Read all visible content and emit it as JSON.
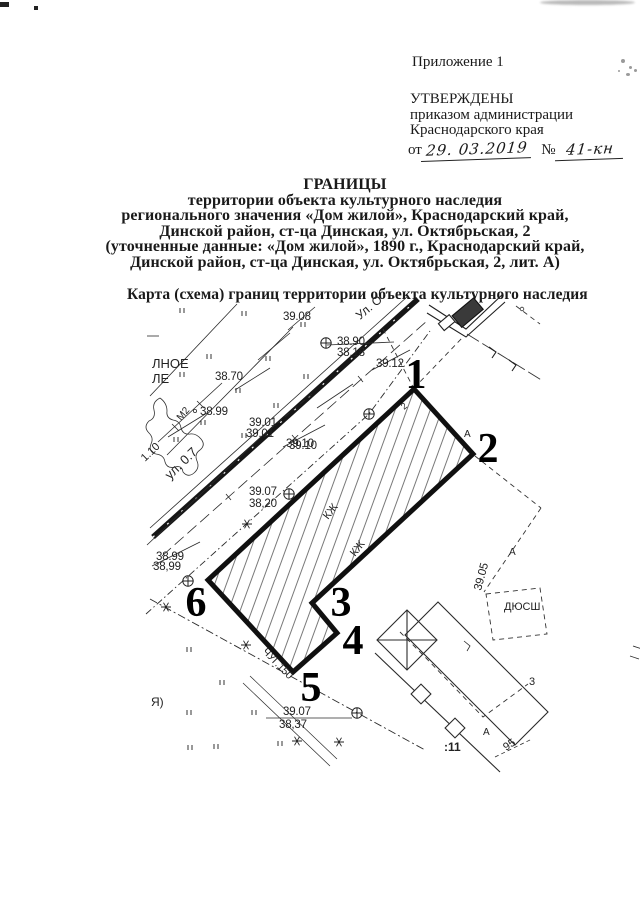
{
  "page": {
    "appendix": "Приложение 1",
    "approval": {
      "line1": "УТВЕРЖДЕНЫ",
      "line2": "приказом администрации",
      "line3": "Краснодарского края",
      "order_prefix": "от",
      "order_date": "29. 03.2019",
      "number_sign": "№",
      "order_number": "41-кн"
    },
    "title_lines": {
      "l1": "ГРАНИЦЫ",
      "l2": "территории объекта культурного наследия",
      "l3": "регионального значения «Дом жилой», Краснодарский край,",
      "l4": "Динской район, ст-ца Динская, ул. Октябрьская, 2",
      "l5": "(уточненные данные: «Дом жилой», 1890 г., Краснодарский край,",
      "l6": "Динской район, ст-ца Динская, ул. Октябрьская, 2, лит. А)"
    },
    "map_caption": "Карта (схема) границ территории объекта культурного наследия"
  },
  "map": {
    "points": [
      "1",
      "2",
      "3",
      "4",
      "5",
      "6"
    ],
    "elev": {
      "e3908": "39.08",
      "e3890": "38.90",
      "e3818": "38,18",
      "e3870": "38.70",
      "e3899a": "38.99",
      "e3901a": "39.01",
      "e3901b": "39,01",
      "e3910": "39.10",
      "e3912": "39.12",
      "e3907a": "39.07",
      "e3820": "38,20",
      "e3899b": "38.99",
      "e3899c": "38,99",
      "e3907b": "39.07",
      "e3837": "38,37",
      "e3905": "39.05"
    },
    "labels": {
      "street_partial": "Ул. О",
      "road_width": "ул. 0.7",
      "w110": "1.10",
      "m2": "М2",
      "pipe": "ЧУГ.150",
      "kzh": "КЖ",
      "dyussh": "ДЮСШ",
      "cad11": ":11",
      "cad95": "95",
      "cad3": "3",
      "lit_a": "А",
      "house2": "2",
      "lnoe": "ЛНОЕ",
      "le": "ЛЕ",
      "ya": "Я)"
    }
  }
}
